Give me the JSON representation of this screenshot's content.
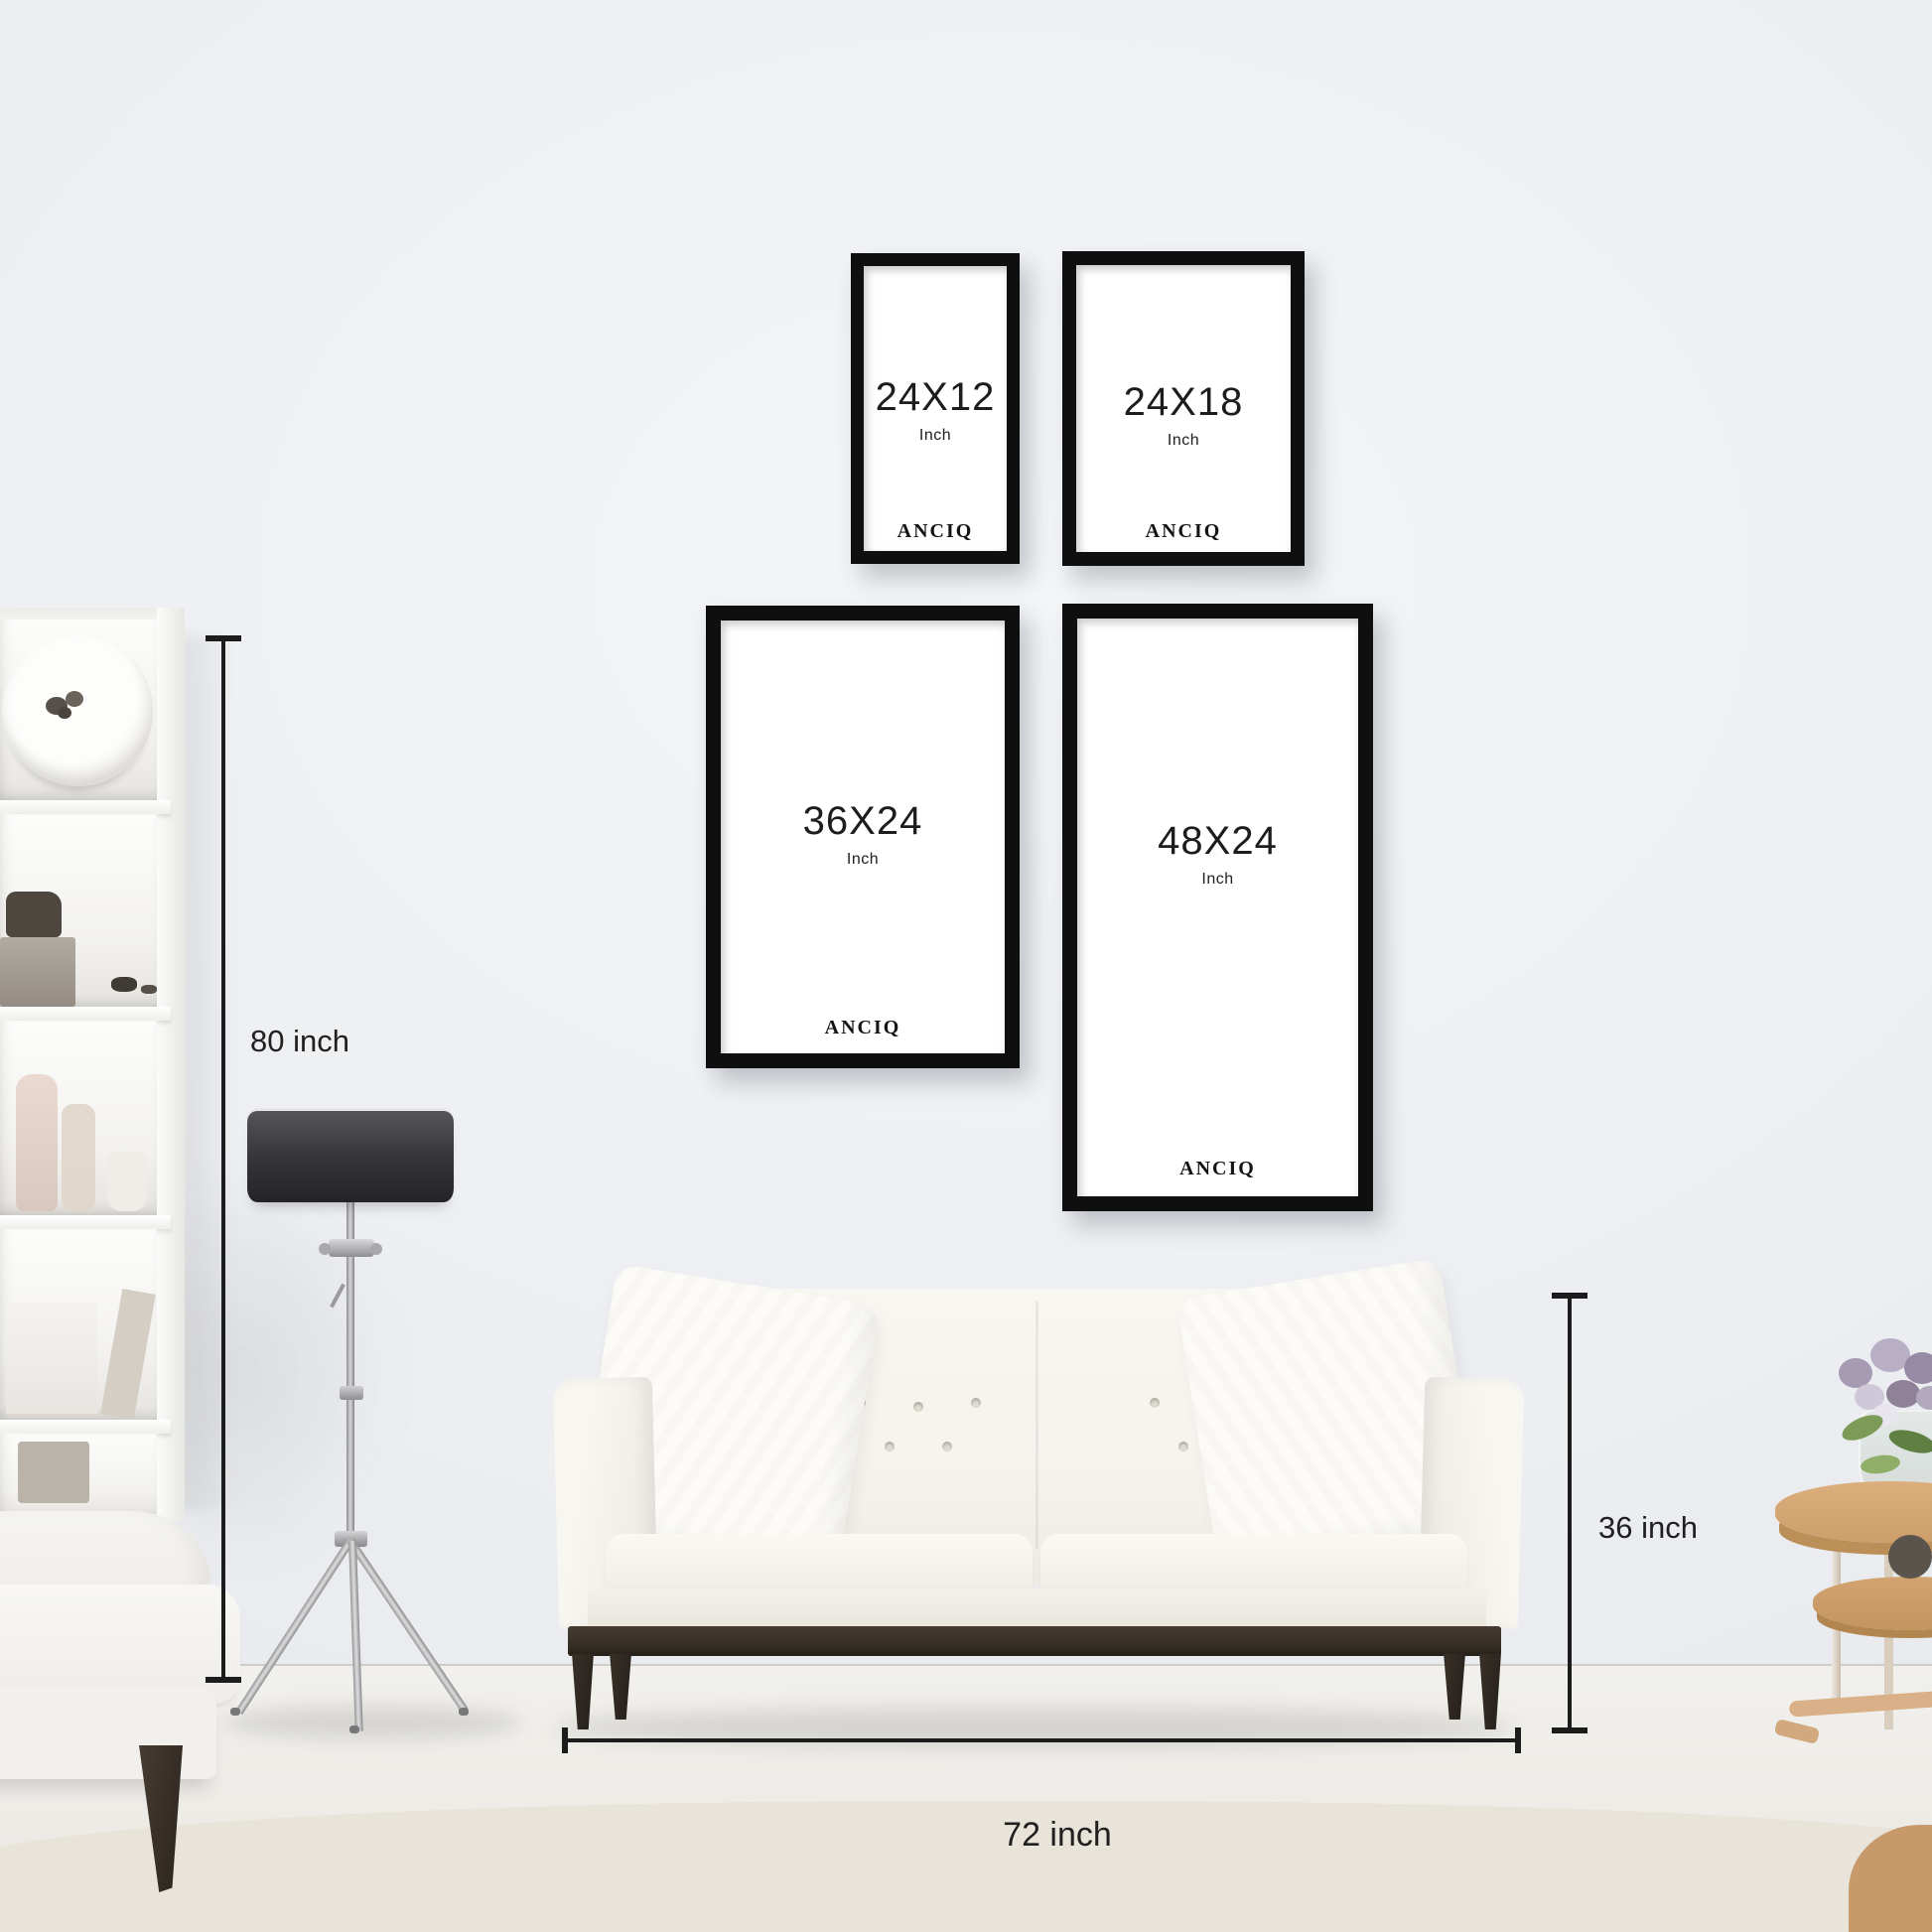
{
  "brand": "ANCIQ",
  "frames": [
    {
      "size": "24X12",
      "unit": "Inch",
      "brand": "ANCIQ"
    },
    {
      "size": "24X18",
      "unit": "Inch",
      "brand": "ANCIQ"
    },
    {
      "size": "36X24",
      "unit": "Inch",
      "brand": "ANCIQ"
    },
    {
      "size": "48X24",
      "unit": "Inch",
      "brand": "ANCIQ"
    }
  ],
  "dimensions": {
    "wall_height": "80 inch",
    "sofa_height": "36 inch",
    "sofa_width": "72 inch"
  },
  "colors": {
    "frame_border": "#0f0f0f",
    "frame_text": "#1d1d1d",
    "dimension_line": "#1c1c1c",
    "wall": "#ebedf0",
    "rug": "#e9e4d9",
    "lamp_shade": "#343436",
    "lamp_stand": "#d7d7d9",
    "sofa_fabric": "#f5f3ed",
    "sofa_wood": "#342c25",
    "table_wood": "#cd9f6d",
    "flower": "#a89cb4",
    "leaf": "#7a9a58"
  }
}
